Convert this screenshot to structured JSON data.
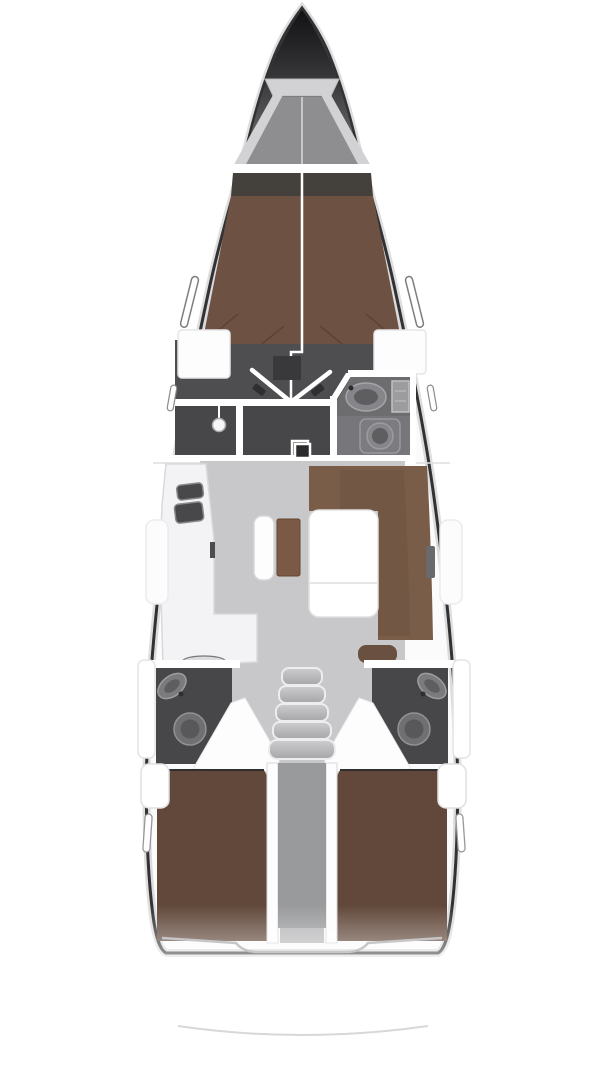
{
  "canvas": {
    "width": 608,
    "height": 1080,
    "background": "#ffffff"
  },
  "diagram_type": "sailing-yacht-interior-floor-plan-top-view",
  "components": [
    "bow",
    "anchor-locker",
    "forward-cabin-berth",
    "wardrobe-lockers",
    "shower-compartment",
    "toilet-compartment",
    "forward-head-sink",
    "forward-head-toilet",
    "cabin-double-doors",
    "salon",
    "galley",
    "galley-sinks",
    "nav-seat",
    "chart-table",
    "salon-table",
    "salon-sofa",
    "mast-foot",
    "companionway-steps",
    "port-aft-head",
    "starboard-aft-head",
    "port-aft-cabin-berth",
    "starboard-aft-cabin-berth",
    "engine-compartment",
    "hull-windows",
    "transom",
    "stern-platform-line"
  ],
  "colors": {
    "background": "#ffffff",
    "hull_stroke": "#323234",
    "hull_soft_edge": "#a8a8aa",
    "deck_white": "#fbfbfc",
    "bow_dark_top": "#121214",
    "bow_dark_mid": "#3a3a3c",
    "bow_dark_bottom": "#808082",
    "anchor_frame": "#d2d2d4",
    "anchor_floor": "#8e8e91",
    "bulkhead_white": "#ffffff",
    "headboard_dark": "#44403b",
    "berth_forward": "#6d5244",
    "berth_aft": "#61483a",
    "berth_seam": "#4a382c",
    "cabin_floor_dark": "#4e4e50",
    "room_dark": "#47474a",
    "head_room_gray": "#77777b",
    "counter_gray": "#6d6d70",
    "fixture_gray": "#86868a",
    "fixture_dark": "#5e5e61",
    "salon_floor": "#c8c8ca",
    "galley_white": "#f3f3f5",
    "sink_dark": "#48484a",
    "sofa_brown": "#7a5d49",
    "sofa_brown_dark": "#6a5040",
    "chart_table_brown": "#7b5a45",
    "table_white": "#ffffff",
    "table_stroke": "#e0e0e2",
    "steps_light": "#c2c2c4",
    "steps_stroke": "#ededef",
    "engine_gray": "#999a9c",
    "engine_light": "#b7b7b9",
    "wall_white": "#ffffff",
    "panel_stroke": "#e2e2e4",
    "line_faint": "#c6c6c8",
    "slit_stroke": "#7e7e81",
    "seat_dark": "#39393b",
    "mast_dark": "#2b2b2d",
    "handle_dark": "#2f2f31",
    "oval_light": "#dcdcde"
  }
}
